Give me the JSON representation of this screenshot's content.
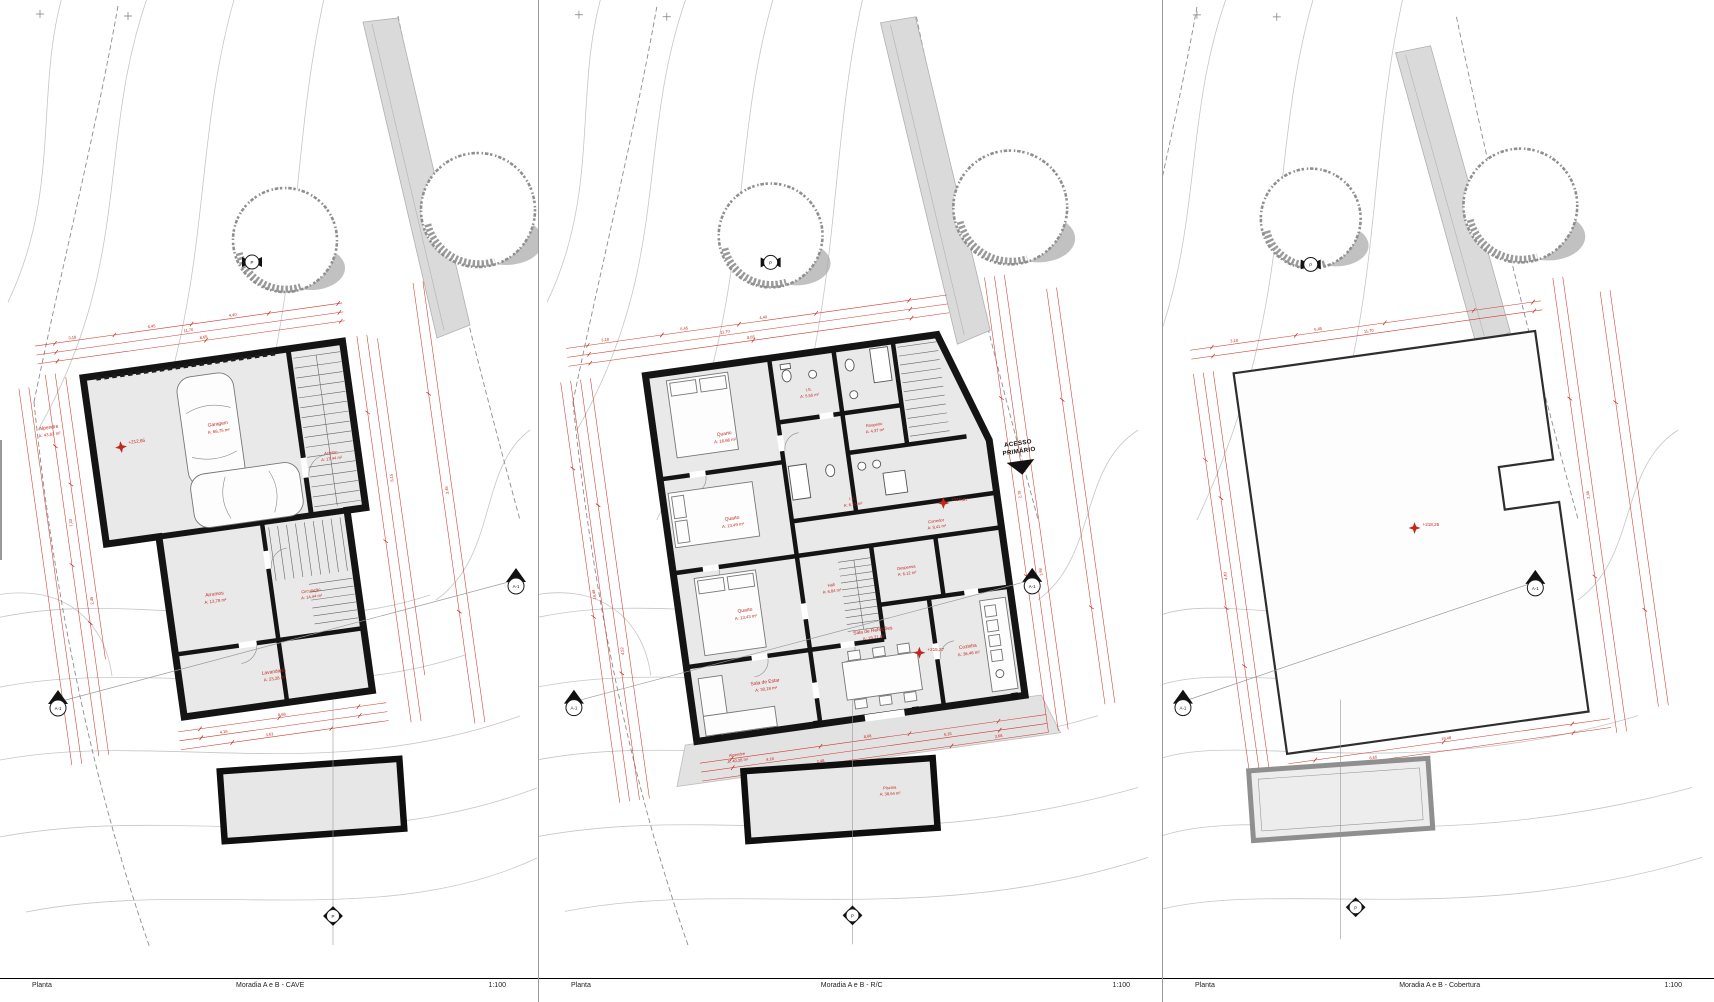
{
  "sheet": {
    "background": "#ffffff",
    "colors": {
      "annotation_red": "#c0281e",
      "wall_black": "#141414",
      "floor_gray": "#e9e9e9",
      "road_gray": "#dadada",
      "tree_gray": "#8f8f8f"
    }
  },
  "panels": [
    {
      "footer": {
        "left": "Planta",
        "center": "Moradia A e B - CAVE",
        "right": "1:100"
      },
      "level": "+212,65",
      "rooms": {
        "alpendre": {
          "name": "Alpendre",
          "area": "A: 43,63 m²"
        },
        "garagem": {
          "name": "Garagem",
          "area": "A: 68,75 m²"
        },
        "acesso": {
          "name": "Acesso",
          "area": "A: 17,44 m²"
        },
        "arrumos": {
          "name": "Arrumos",
          "area": "A: 13,78 m²"
        },
        "circulacao": {
          "name": "Circulação",
          "area": "A: 14,44 m²"
        },
        "lavandaria": {
          "name": "Lavandaria",
          "area": "A: 23,28 m²"
        }
      },
      "dims": [
        "3,18",
        "6,45",
        "4,40",
        "11,70",
        "8,65",
        "2,45",
        "3,45",
        "8,68",
        "4,16",
        "3,63",
        "7,33",
        "6,15"
      ],
      "markers": {
        "section_left": "A-1",
        "section_right": "A-1",
        "top": "P",
        "bottom": "P"
      }
    },
    {
      "footer": {
        "left": "Planta",
        "center": "Moradia A e B - R/C",
        "right": "1:100"
      },
      "levels": [
        "+215,27",
        "+215,27"
      ],
      "access": {
        "line1": "ACESSO",
        "line2": "PRIMÁRIO"
      },
      "rooms": {
        "quarto1": {
          "name": "Quarto",
          "area": "A: 16,66 m²"
        },
        "is1": {
          "name": "I.S.",
          "area": "A: 5,55 m²"
        },
        "roupeiro": {
          "name": "Roupeiro",
          "area": "A: 4,37 m²"
        },
        "quarto2": {
          "name": "Quarto",
          "area": "A: 13,49 m²"
        },
        "is2": {
          "name": "I.S.",
          "area": "A: 6,15 m²"
        },
        "quarto3": {
          "name": "Quarto",
          "area": "A: 13,43 m²"
        },
        "corredor": {
          "name": "Corredor",
          "area": "A: 8,41 m²"
        },
        "hall": {
          "name": "Hall",
          "area": "A: 6,84 m²"
        },
        "despensa": {
          "name": "Despensa",
          "area": "A: 6,12 m²"
        },
        "cozinha": {
          "name": "Cozinha",
          "area": "A: 36,46 m²"
        },
        "sala_estar": {
          "name": "Sala de Estar",
          "area": "A: 30,19 m²"
        },
        "sala_refeicoes": {
          "name": "Sala de Refeições",
          "area": "A: 19,71 m²"
        },
        "alpendre": {
          "name": "Alpendre",
          "area": "A: 40,28 m²"
        },
        "piscina": {
          "name": "Piscina",
          "area": "A: 38,64 m²"
        }
      },
      "dims": [
        "3,18",
        "6,45",
        "4,40",
        "11,70",
        "8,65",
        "4,18",
        "6,15",
        "2,78",
        "1,98",
        "8,68",
        "4,52",
        "2,48",
        "19,48",
        "3,68"
      ],
      "markers": {
        "section_left": "A-1",
        "section_right": "A-1",
        "top": "P",
        "bottom": "P"
      }
    },
    {
      "footer": {
        "left": "Planta",
        "center": "Moradia A e B - Cobertura",
        "right": "1:100"
      },
      "level": "+218,25",
      "dims": [
        "3,18",
        "6,45",
        "11,70",
        "8,65",
        "4,40",
        "2,45",
        "19,48"
      ],
      "markers": {
        "section_left": "A-1",
        "section_right": "A-1",
        "top": "P",
        "bottom": "P"
      }
    }
  ]
}
